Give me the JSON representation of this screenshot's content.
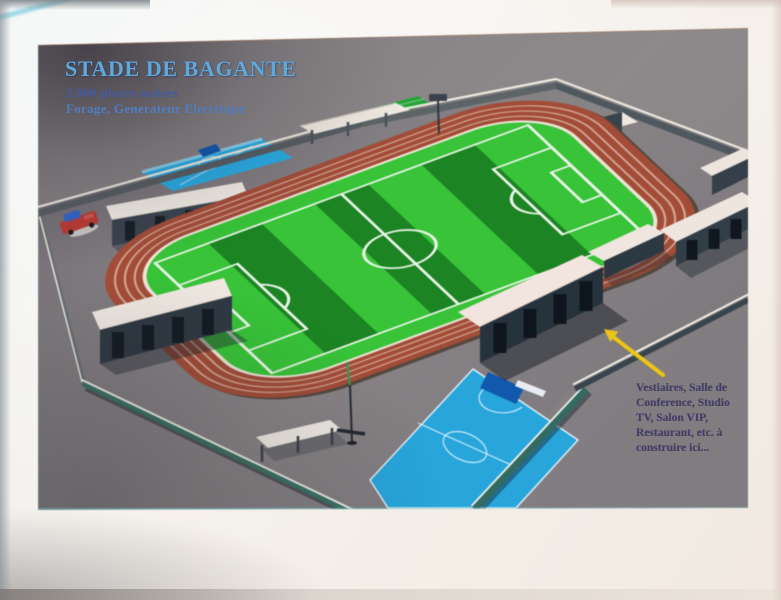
{
  "slide": {
    "title": "STADE DE BAGANTE",
    "capacity_line": "2.000 places assises",
    "facilities_line": "Forage, Generateur Electrique",
    "annotation": {
      "text": "Vestiaires, Salle de\nConference, Studio\nTV, Salon VIP,\nRestaurant, etc. à\nconstruire ici...",
      "pointer_icon": "yellow-arrow-icon"
    },
    "scene_colors": {
      "pitch_light_green": "#3cc13c",
      "pitch_dark_green": "#1f8326",
      "track_red": "#a04e3a",
      "court_blue": "#2aa7dc",
      "arrow_yellow": "#e9c51f",
      "title_blue": "#5fa8d8",
      "capacity_blue": "#3c5ea6",
      "facilities_blue": "#4b80c4",
      "annotation_navy": "#3a4066"
    }
  }
}
